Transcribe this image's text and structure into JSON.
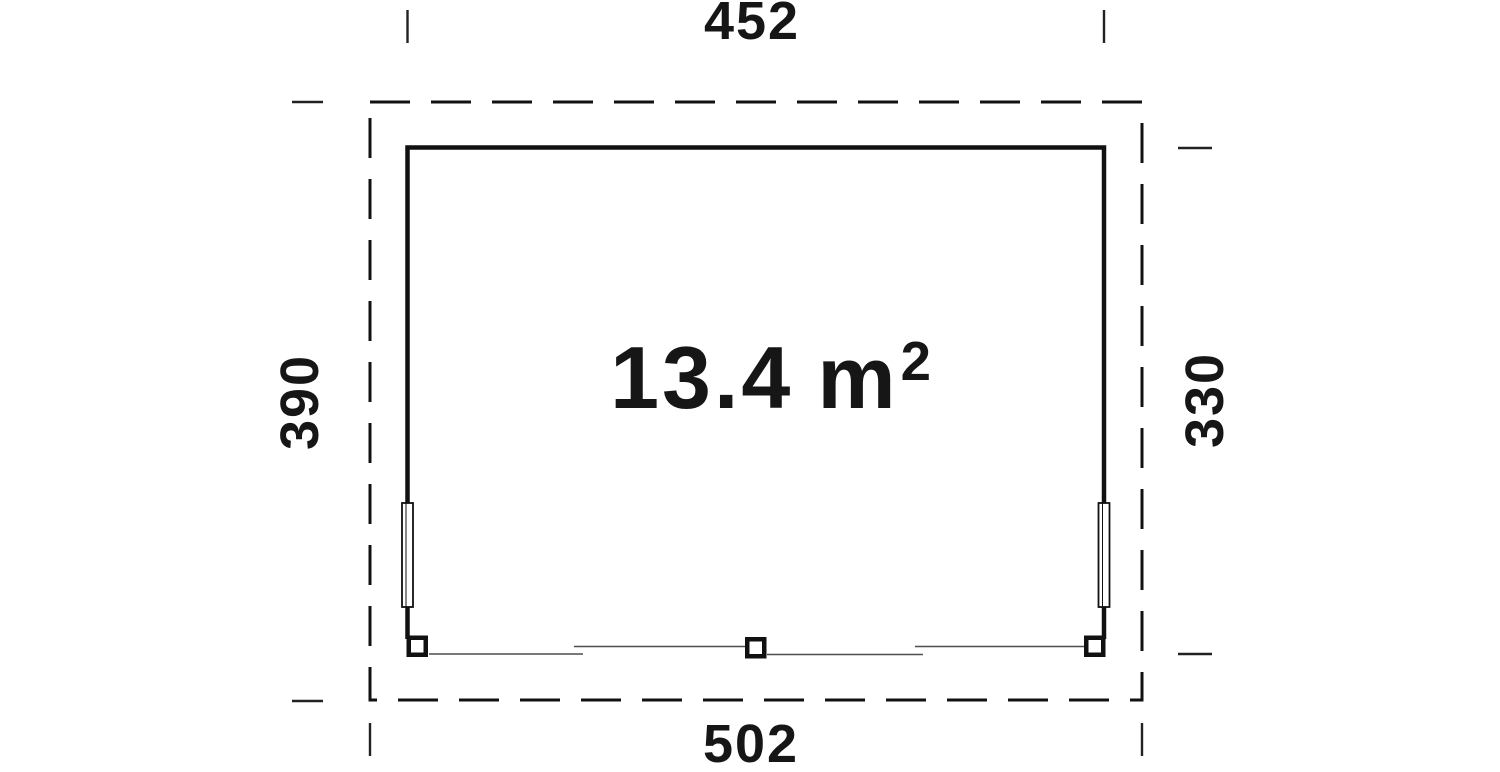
{
  "plan": {
    "area": {
      "value": "13.4",
      "unit": "m",
      "exponent": "2"
    },
    "dimensions": {
      "top": "452",
      "bottom": "502",
      "left": "390",
      "right": "330"
    }
  },
  "colors": {
    "line": "#111111",
    "thin_line": "#4d4d4d",
    "tick": "#222222",
    "background": "#ffffff",
    "text": "#161616"
  }
}
